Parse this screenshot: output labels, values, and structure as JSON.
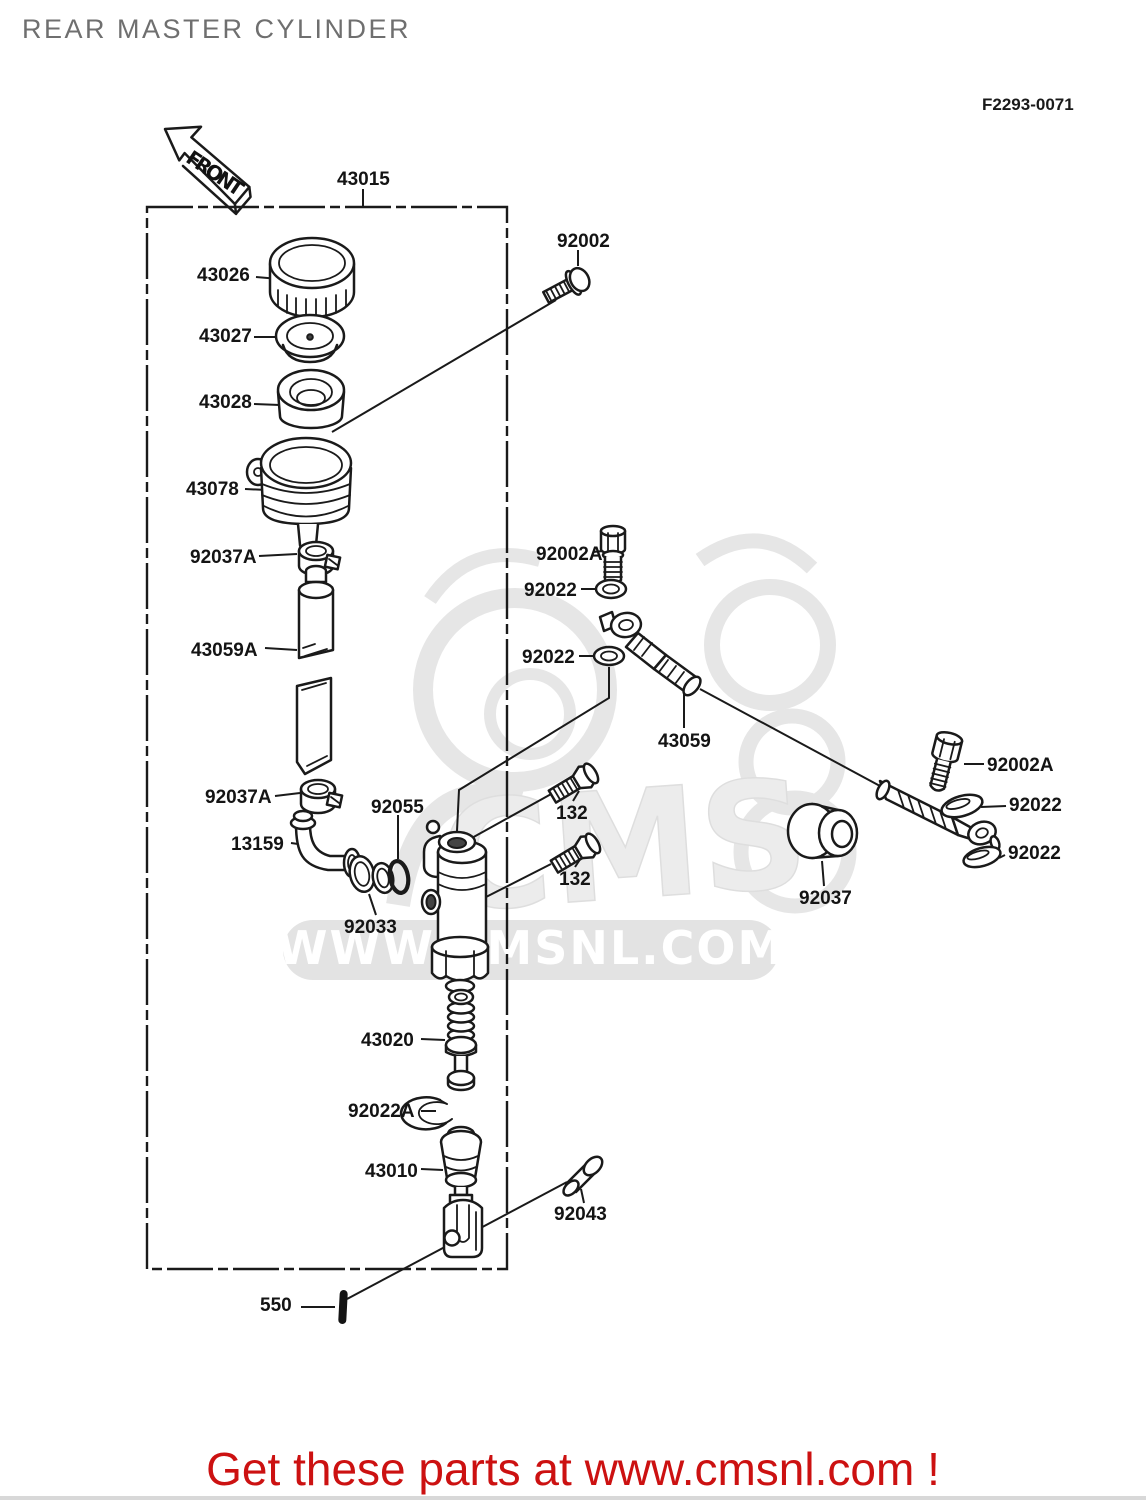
{
  "header": {
    "title": "REAR MASTER CYLINDER",
    "diagram_code": "F2293-0071"
  },
  "front_arrow": {
    "label": "FRONT"
  },
  "watermark": {
    "logo_text": "CMS",
    "site_text": "WWW.CMSNL.COM"
  },
  "footer": {
    "text": "Get these parts at www.cmsnl.com !"
  },
  "colors": {
    "ink": "#1a1a1a",
    "title_gray": "#6f6f6f",
    "footer_red": "#cc1111",
    "watermark_gray": "#e6e6e6"
  },
  "parts": [
    {
      "ref": "43015"
    },
    {
      "ref": "43026"
    },
    {
      "ref": "43027"
    },
    {
      "ref": "43028"
    },
    {
      "ref": "43078"
    },
    {
      "ref": "92037A"
    },
    {
      "ref": "43059A"
    },
    {
      "ref": "92037A"
    },
    {
      "ref": "13159"
    },
    {
      "ref": "92055"
    },
    {
      "ref": "92033"
    },
    {
      "ref": "92002"
    },
    {
      "ref": "92002A"
    },
    {
      "ref": "92022"
    },
    {
      "ref": "92022"
    },
    {
      "ref": "43059"
    },
    {
      "ref": "132"
    },
    {
      "ref": "132"
    },
    {
      "ref": "92002A"
    },
    {
      "ref": "92022"
    },
    {
      "ref": "92022"
    },
    {
      "ref": "92037"
    },
    {
      "ref": "43020"
    },
    {
      "ref": "92022A"
    },
    {
      "ref": "43010"
    },
    {
      "ref": "92043"
    },
    {
      "ref": "550"
    }
  ]
}
